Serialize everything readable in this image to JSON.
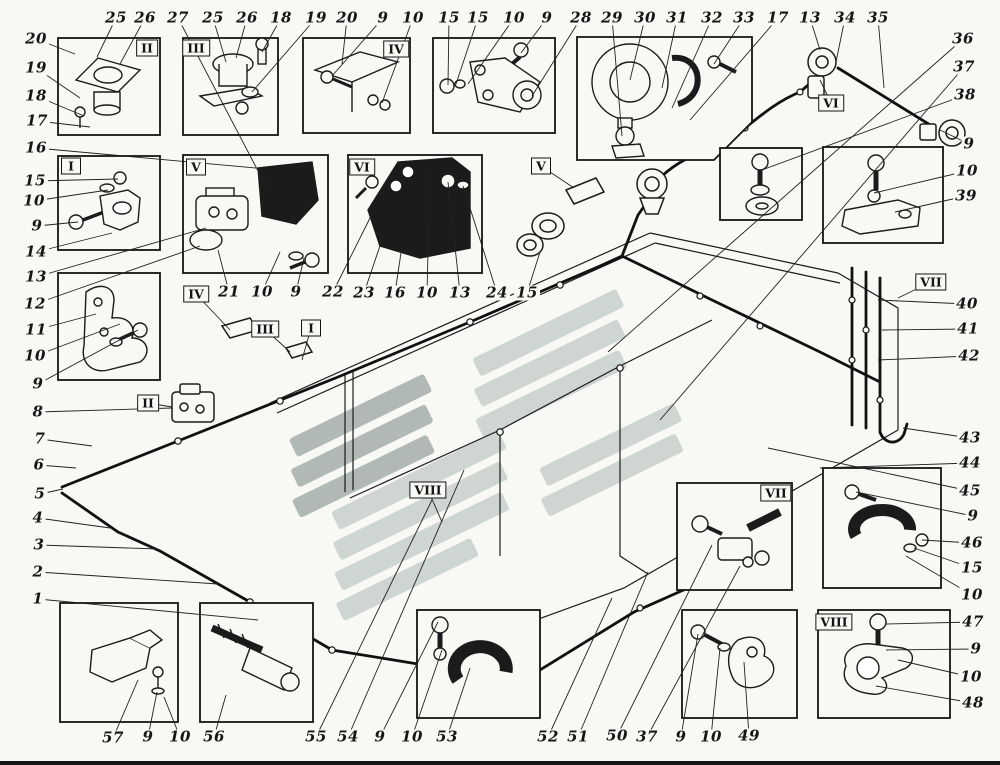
{
  "page": {
    "background": "#f8f8f5",
    "ink": "#1b1b1b",
    "bottom_rule": "#121212"
  },
  "watermark": {
    "light": "#cdd5d1",
    "dark": "#aeb6b3"
  },
  "part_callouts": [
    {
      "t": "25",
      "x": 116,
      "y": 18,
      "tx": 97,
      "ty": 57
    },
    {
      "t": "26",
      "x": 145,
      "y": 18,
      "tx": 120,
      "ty": 64
    },
    {
      "t": "27",
      "x": 178,
      "y": 18,
      "tx": 268,
      "ty": 190
    },
    {
      "t": "25",
      "x": 213,
      "y": 18,
      "tx": 226,
      "ty": 62
    },
    {
      "t": "26",
      "x": 247,
      "y": 18,
      "tx": 236,
      "ty": 58
    },
    {
      "t": "18",
      "x": 281,
      "y": 18,
      "tx": 262,
      "ty": 52
    },
    {
      "t": "19",
      "x": 316,
      "y": 18,
      "tx": 252,
      "ty": 92
    },
    {
      "t": "20",
      "x": 347,
      "y": 18,
      "tx": 342,
      "ty": 64
    },
    {
      "t": "9",
      "x": 383,
      "y": 18,
      "tx": 332,
      "ty": 76
    },
    {
      "t": "10",
      "x": 413,
      "y": 18,
      "tx": 382,
      "ty": 103
    },
    {
      "t": "15",
      "x": 449,
      "y": 18,
      "tx": 448,
      "ty": 85
    },
    {
      "t": "15",
      "x": 478,
      "y": 18,
      "tx": 456,
      "ty": 84
    },
    {
      "t": "10",
      "x": 514,
      "y": 18,
      "tx": 468,
      "ty": 84
    },
    {
      "t": "9",
      "x": 547,
      "y": 18,
      "tx": 521,
      "ty": 53
    },
    {
      "t": "28",
      "x": 581,
      "y": 18,
      "tx": 532,
      "ty": 96
    },
    {
      "t": "29",
      "x": 612,
      "y": 18,
      "tx": 622,
      "ty": 136
    },
    {
      "t": "30",
      "x": 645,
      "y": 18,
      "tx": 630,
      "ty": 80
    },
    {
      "t": "31",
      "x": 677,
      "y": 18,
      "tx": 662,
      "ty": 88
    },
    {
      "t": "32",
      "x": 712,
      "y": 18,
      "tx": 672,
      "ty": 108
    },
    {
      "t": "33",
      "x": 744,
      "y": 18,
      "tx": 714,
      "ty": 64
    },
    {
      "t": "17",
      "x": 778,
      "y": 18,
      "tx": 690,
      "ty": 120
    },
    {
      "t": "13",
      "x": 810,
      "y": 18,
      "tx": 820,
      "ty": 50
    },
    {
      "t": "34",
      "x": 845,
      "y": 18,
      "tx": 836,
      "ty": 62
    },
    {
      "t": "35",
      "x": 878,
      "y": 18,
      "tx": 884,
      "ty": 88
    },
    {
      "t": "36",
      "x": 963,
      "y": 39,
      "tx": 608,
      "ty": 352
    },
    {
      "t": "37",
      "x": 964,
      "y": 67,
      "tx": 660,
      "ty": 420
    },
    {
      "t": "38",
      "x": 965,
      "y": 95,
      "tx": 762,
      "ty": 170
    },
    {
      "t": "9",
      "x": 969,
      "y": 144,
      "tx": 940,
      "ty": 130
    },
    {
      "t": "10",
      "x": 967,
      "y": 171,
      "tx": 874,
      "ty": 193
    },
    {
      "t": "39",
      "x": 966,
      "y": 196,
      "tx": 895,
      "ty": 212
    },
    {
      "t": "40",
      "x": 967,
      "y": 304,
      "tx": 878,
      "ty": 300
    },
    {
      "t": "41",
      "x": 968,
      "y": 329,
      "tx": 882,
      "ty": 330
    },
    {
      "t": "42",
      "x": 969,
      "y": 356,
      "tx": 878,
      "ty": 360
    },
    {
      "t": "43",
      "x": 970,
      "y": 438,
      "tx": 903,
      "ty": 428
    },
    {
      "t": "44",
      "x": 970,
      "y": 463,
      "tx": 820,
      "ty": 468
    },
    {
      "t": "45",
      "x": 970,
      "y": 491,
      "tx": 768,
      "ty": 448
    },
    {
      "t": "9",
      "x": 973,
      "y": 516,
      "tx": 856,
      "ty": 492
    },
    {
      "t": "46",
      "x": 972,
      "y": 543,
      "tx": 922,
      "ty": 540
    },
    {
      "t": "15",
      "x": 972,
      "y": 568,
      "tx": 914,
      "ty": 548
    },
    {
      "t": "10",
      "x": 972,
      "y": 595,
      "tx": 906,
      "ty": 556
    },
    {
      "t": "47",
      "x": 973,
      "y": 622,
      "tx": 886,
      "ty": 624
    },
    {
      "t": "9",
      "x": 976,
      "y": 649,
      "tx": 886,
      "ty": 650
    },
    {
      "t": "10",
      "x": 971,
      "y": 677,
      "tx": 898,
      "ty": 660
    },
    {
      "t": "48",
      "x": 973,
      "y": 703,
      "tx": 876,
      "ty": 686
    },
    {
      "t": "20",
      "x": 36,
      "y": 39,
      "tx": 75,
      "ty": 54
    },
    {
      "t": "19",
      "x": 36,
      "y": 68,
      "tx": 80,
      "ty": 98
    },
    {
      "t": "18",
      "x": 36,
      "y": 96,
      "tx": 84,
      "ty": 116
    },
    {
      "t": "17",
      "x": 37,
      "y": 121,
      "tx": 90,
      "ty": 127
    },
    {
      "t": "16",
      "x": 36,
      "y": 148,
      "tx": 256,
      "ty": 168
    },
    {
      "t": "15",
      "x": 35,
      "y": 181,
      "tx": 118,
      "ty": 179
    },
    {
      "t": "10",
      "x": 34,
      "y": 201,
      "tx": 108,
      "ty": 190
    },
    {
      "t": "9",
      "x": 37,
      "y": 226,
      "tx": 78,
      "ty": 222
    },
    {
      "t": "14",
      "x": 36,
      "y": 252,
      "tx": 112,
      "ty": 233
    },
    {
      "t": "13",
      "x": 36,
      "y": 277,
      "tx": 206,
      "ty": 228
    },
    {
      "t": "12",
      "x": 35,
      "y": 304,
      "tx": 200,
      "ty": 246
    },
    {
      "t": "11",
      "x": 36,
      "y": 330,
      "tx": 96,
      "ty": 314
    },
    {
      "t": "10",
      "x": 35,
      "y": 356,
      "tx": 120,
      "ty": 324
    },
    {
      "t": "9",
      "x": 38,
      "y": 384,
      "tx": 138,
      "ty": 330
    },
    {
      "t": "8",
      "x": 38,
      "y": 412,
      "tx": 172,
      "ty": 408
    },
    {
      "t": "7",
      "x": 40,
      "y": 439,
      "tx": 92,
      "ty": 446
    },
    {
      "t": "6",
      "x": 39,
      "y": 465,
      "tx": 76,
      "ty": 468
    },
    {
      "t": "5",
      "x": 40,
      "y": 494,
      "tx": 63,
      "ty": 489
    },
    {
      "t": "4",
      "x": 38,
      "y": 518,
      "tx": 110,
      "ty": 528
    },
    {
      "t": "3",
      "x": 39,
      "y": 545,
      "tx": 158,
      "ty": 549
    },
    {
      "t": "2",
      "x": 38,
      "y": 572,
      "tx": 218,
      "ty": 584
    },
    {
      "t": "1",
      "x": 38,
      "y": 599,
      "tx": 258,
      "ty": 620
    },
    {
      "t": "21",
      "x": 229,
      "y": 292,
      "tx": 218,
      "ty": 250
    },
    {
      "t": "10",
      "x": 262,
      "y": 292,
      "tx": 280,
      "ty": 252
    },
    {
      "t": "9",
      "x": 296,
      "y": 292,
      "tx": 304,
      "ty": 258
    },
    {
      "t": "22",
      "x": 333,
      "y": 292,
      "tx": 372,
      "ty": 214
    },
    {
      "t": "23",
      "x": 364,
      "y": 293,
      "tx": 384,
      "ty": 234
    },
    {
      "t": "16",
      "x": 395,
      "y": 293,
      "tx": 402,
      "ty": 246
    },
    {
      "t": "10",
      "x": 427,
      "y": 293,
      "tx": 430,
      "ty": 172
    },
    {
      "t": "13",
      "x": 460,
      "y": 293,
      "tx": 448,
      "ty": 182
    },
    {
      "t": "24",
      "x": 497,
      "y": 293,
      "tx": 463,
      "ty": 186
    },
    {
      "t": "15",
      "x": 527,
      "y": 293,
      "tx": 540,
      "ty": 252
    },
    {
      "t": "57",
      "x": 113,
      "y": 738,
      "tx": 138,
      "ty": 680
    },
    {
      "t": "9",
      "x": 148,
      "y": 737,
      "tx": 157,
      "ty": 692
    },
    {
      "t": "10",
      "x": 180,
      "y": 737,
      "tx": 164,
      "ty": 697
    },
    {
      "t": "56",
      "x": 214,
      "y": 737,
      "tx": 226,
      "ty": 695
    },
    {
      "t": "55",
      "x": 316,
      "y": 737,
      "tx": 432,
      "ty": 500
    },
    {
      "t": "54",
      "x": 348,
      "y": 737,
      "tx": 464,
      "ty": 470
    },
    {
      "t": "9",
      "x": 380,
      "y": 737,
      "tx": 438,
      "ty": 622
    },
    {
      "t": "10",
      "x": 412,
      "y": 737,
      "tx": 442,
      "ty": 650
    },
    {
      "t": "53",
      "x": 447,
      "y": 737,
      "tx": 470,
      "ty": 668
    },
    {
      "t": "52",
      "x": 548,
      "y": 737,
      "tx": 612,
      "ty": 598
    },
    {
      "t": "51",
      "x": 578,
      "y": 737,
      "tx": 648,
      "ty": 572
    },
    {
      "t": "50",
      "x": 617,
      "y": 736,
      "tx": 712,
      "ty": 545
    },
    {
      "t": "37",
      "x": 647,
      "y": 737,
      "tx": 740,
      "ty": 566
    },
    {
      "t": "9",
      "x": 681,
      "y": 737,
      "tx": 698,
      "ty": 634
    },
    {
      "t": "10",
      "x": 711,
      "y": 737,
      "tx": 720,
      "ty": 648
    },
    {
      "t": "49",
      "x": 749,
      "y": 736,
      "tx": 744,
      "ty": 662
    }
  ],
  "roman_flags": [
    {
      "t": "II",
      "x": 147,
      "y": 48
    },
    {
      "t": "III",
      "x": 196,
      "y": 48
    },
    {
      "t": "IV",
      "x": 396,
      "y": 49
    },
    {
      "t": "I",
      "x": 71,
      "y": 166
    },
    {
      "t": "V",
      "x": 196,
      "y": 167
    },
    {
      "t": "VI",
      "x": 362,
      "y": 167
    },
    {
      "t": "V",
      "x": 541,
      "y": 166,
      "tx": 574,
      "ty": 188
    },
    {
      "t": "VI",
      "x": 831,
      "y": 103,
      "tx": 820,
      "ty": 80
    },
    {
      "t": "VII",
      "x": 931,
      "y": 282,
      "tx": 898,
      "ty": 298
    },
    {
      "t": "IV",
      "x": 196,
      "y": 294,
      "tx": 230,
      "ty": 330
    },
    {
      "t": "III",
      "x": 265,
      "y": 329,
      "tx": 290,
      "ty": 352
    },
    {
      "t": "I",
      "x": 311,
      "y": 328,
      "tx": 302,
      "ty": 360
    },
    {
      "t": "II",
      "x": 148,
      "y": 403,
      "tx": 172,
      "ty": 407
    },
    {
      "t": "VIII",
      "x": 428,
      "y": 490,
      "tx": 442,
      "ty": 522
    },
    {
      "t": "VII",
      "x": 776,
      "y": 493
    },
    {
      "t": "VIII",
      "x": 834,
      "y": 622
    }
  ]
}
